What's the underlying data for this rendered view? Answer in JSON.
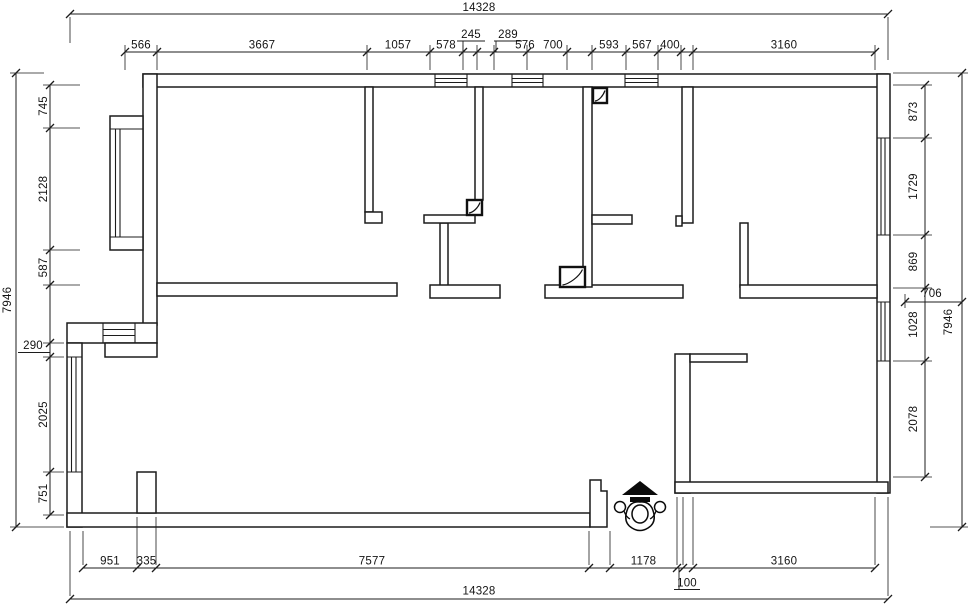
{
  "plan": {
    "dims": {
      "top_overall": "14328",
      "top": [
        "566",
        "3667",
        "1057",
        "578",
        "245",
        "289",
        "576",
        "700",
        "593",
        "567",
        "400",
        "3160"
      ],
      "left": [
        "745",
        "2128",
        "587",
        "290",
        "2025",
        "751"
      ],
      "left_overall": "7946",
      "right": [
        "873",
        "1729",
        "869",
        "1028",
        "2078"
      ],
      "right_depth": "706",
      "right_overall": "7946",
      "bottom": [
        "951",
        "335",
        "7577",
        "1178",
        "100",
        "3160"
      ],
      "bottom_overall": "14328"
    },
    "icons": {
      "entry_marker": "entry-arrow-with-person-figure",
      "column_marker": "floor-drain-square-symbol"
    }
  }
}
